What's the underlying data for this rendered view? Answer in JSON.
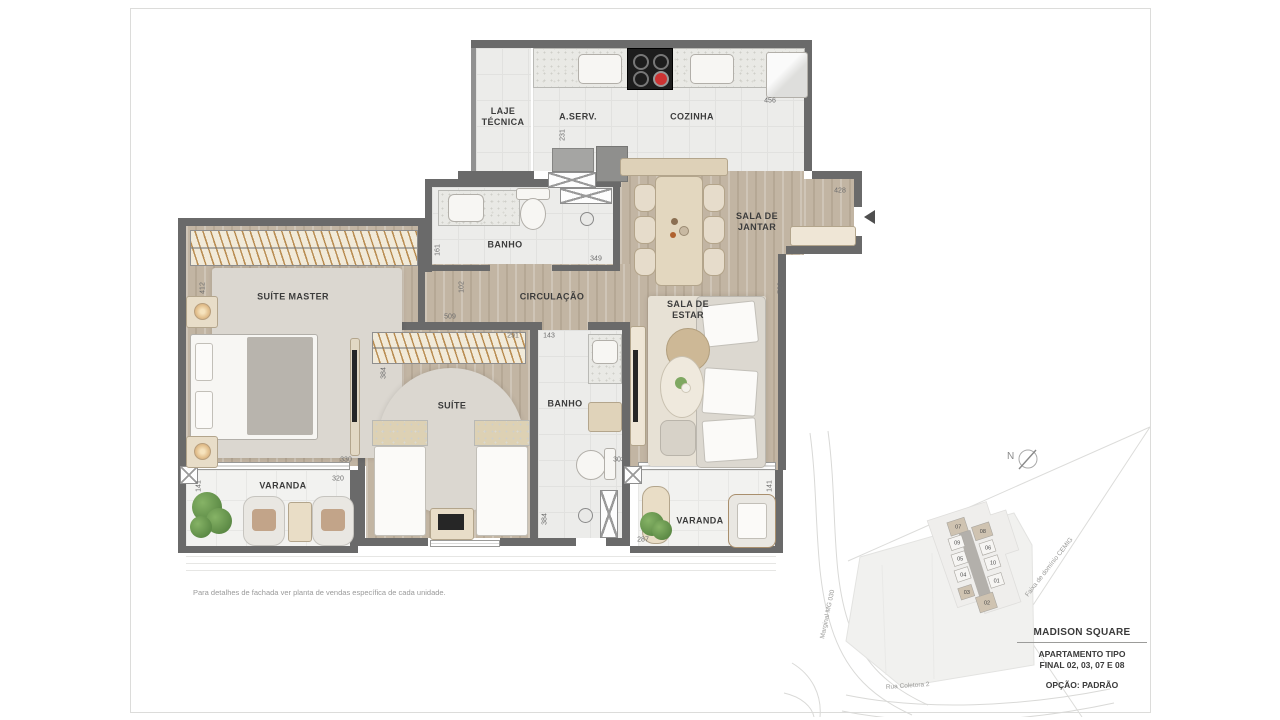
{
  "sheet": {
    "disclaimer": "Para detalhes de fachada ver planta de vendas específica de cada unidade."
  },
  "rooms": {
    "laje_tecnica": "LAJE\nTÉCNICA",
    "aserv": "A.SERV.",
    "cozinha": "COZINHA",
    "banho1": "BANHO",
    "sala_jantar": "SALA DE\nJANTAR",
    "circulacao": "CIRCULAÇÃO",
    "suite_master": "SUÍTE MASTER",
    "suite": "SUÍTE",
    "banho2": "BANHO",
    "sala_estar": "SALA DE\nESTAR",
    "varanda_left": "VARANDA",
    "varanda_right": "VARANDA"
  },
  "dimensions": {
    "d456": "456",
    "d231": "231",
    "d428": "428",
    "d161": "161",
    "d349": "349",
    "d102": "102",
    "d412": "412",
    "d509": "509",
    "d291": "291",
    "d143": "143",
    "d384_suite": "384",
    "d330": "330",
    "d320": "320",
    "d141_left": "141",
    "d384_banho": "384",
    "d303": "303",
    "d287": "287",
    "d723": "723",
    "d141_right": "141"
  },
  "site_map": {
    "compass": "N",
    "roads": {
      "marginal": "Marginal MG 030",
      "coletora": "Rua Coletora 2",
      "faixa": "Faixa de domínio CEMIG"
    },
    "units": [
      {
        "n": "07"
      },
      {
        "n": "08"
      },
      {
        "n": "09"
      },
      {
        "n": "06"
      },
      {
        "n": "05"
      },
      {
        "n": "10"
      },
      {
        "n": "04"
      },
      {
        "n": "01"
      },
      {
        "n": "03"
      },
      {
        "n": "02"
      }
    ]
  },
  "title_block": {
    "project": "MADISON SQUARE",
    "line1": "APARTAMENTO TIPO",
    "line2": "FINAL 02, 03, 07 E 08",
    "line3": "OPÇÃO: PADRÃO"
  },
  "colors": {
    "wall": "#6a6a6a",
    "wood_floor": "#c2b5a3",
    "tile_floor": "#ececea",
    "furniture_beige": "#ded1b8",
    "highlight_unit": "#cfc3b1"
  }
}
